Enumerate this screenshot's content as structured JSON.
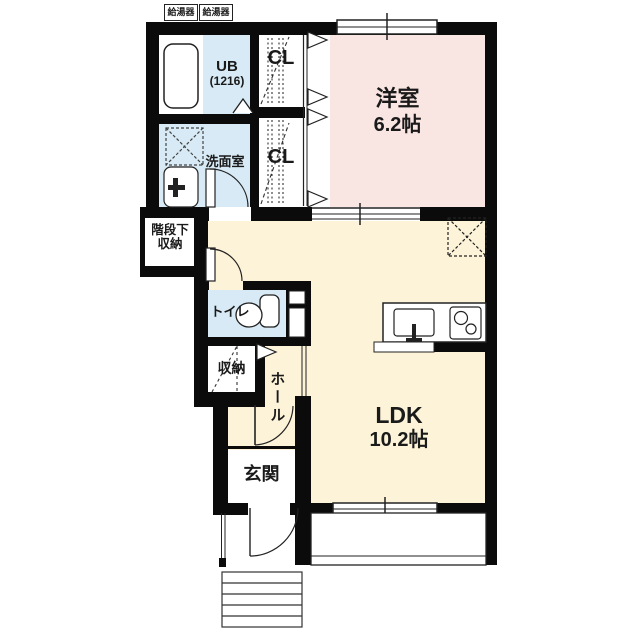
{
  "water_heater_left": "給湯器",
  "water_heater_right": "給湯器",
  "rooms": {
    "unit_bath": {
      "name": "UB",
      "size": "(1216)"
    },
    "closet_top": "CL",
    "closet_bottom": "CL",
    "western_room": {
      "name": "洋室",
      "size": "6.2帖"
    },
    "washroom": "洗面室",
    "under_stair_storage": {
      "line1": "階段下",
      "line2": "収納"
    },
    "toilet": "トイレ",
    "storage": "収納",
    "hall": "ホール",
    "ldk": {
      "name": "LDK",
      "size": "10.2帖"
    },
    "entrance": "玄関"
  },
  "colors": {
    "western_room_fill": "#f9e5e1",
    "ldk_fill": "#fdf3d8",
    "wet_area_fill": "#d7eaf5",
    "wall": "#0b0b0b"
  }
}
